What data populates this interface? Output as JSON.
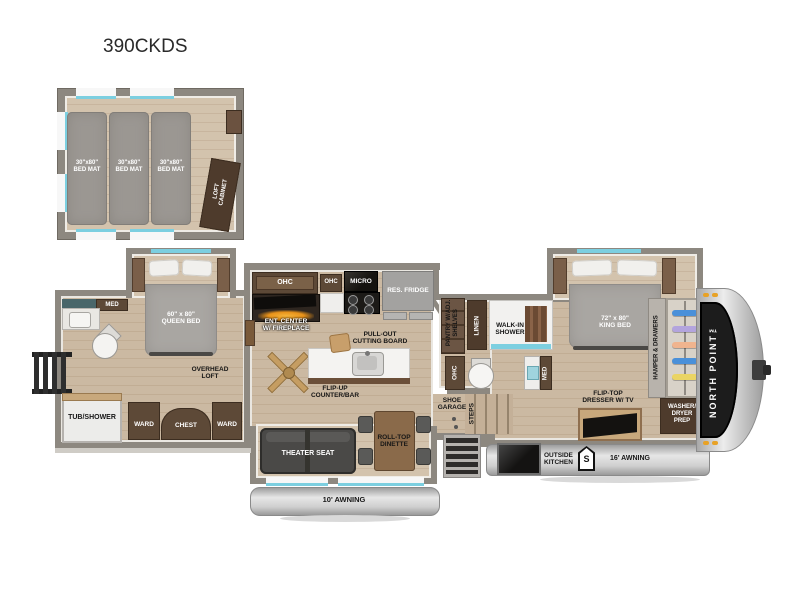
{
  "title": "390CKDS",
  "loft": {
    "mat_size": "30\"x80\"",
    "mat_label": "BED MAT",
    "cabinet_l1": "LOFT",
    "cabinet_l2": "CABINET"
  },
  "rear": {
    "med": "MED",
    "tub_shower": "TUB/SHOWER",
    "queen_size": "60\" x 80\"",
    "queen_label": "QUEEN BED",
    "overhead_l1": "OVERHEAD",
    "overhead_l2": "LOFT",
    "ward": "WARD",
    "chest": "CHEST"
  },
  "kitchen": {
    "ohc": "OHC",
    "micro": "MICRO",
    "fridge": "RES. FRIDGE",
    "ent_l1": "ENT. CENTER",
    "ent_l2": "W/ FIREPLACE",
    "pullout_l1": "PULL-OUT",
    "pullout_l2": "CUTTING BOARD",
    "flipup_l1": "FLIP-UP",
    "flipup_l2": "COUNTER/BAR",
    "pantry_l1": "PANTRY W/ADJ.",
    "pantry_l2": "SHELVES"
  },
  "bath": {
    "linen": "LINEN",
    "shower_l1": "WALK-IN",
    "shower_l2": "SHOWER",
    "med": "MED"
  },
  "entry": {
    "shoe_l1": "SHOE",
    "shoe_l2": "GARAGE",
    "steps": "STEPS"
  },
  "living": {
    "theater": "THEATER SEAT",
    "dinette_l1": "ROLL-TOP",
    "dinette_l2": "DINETTE"
  },
  "front": {
    "king_size": "72\" x 80\"",
    "king_label": "KING BED",
    "dresser_l1": "FLIP-TOP",
    "dresser_l2": "DRESSER W/ TV",
    "hamper": "HAMPER & DRAWERS",
    "wd_l1": "WASHER/",
    "wd_l2": "DRYER",
    "wd_l3": "PREP",
    "brand": "NORTH POINT™"
  },
  "exterior": {
    "awning_rear": "10' AWNING",
    "awning_main": "16' AWNING",
    "ok_l1": "OUTSIDE",
    "ok_l2": "KITCHEN",
    "s_badge": "S"
  },
  "colors": {
    "accent_teal": "#7ccfe0",
    "wall_gray": "#8d8880",
    "cabinet_brown": "#5d4937",
    "fireplace_glow": "#e8921a"
  }
}
